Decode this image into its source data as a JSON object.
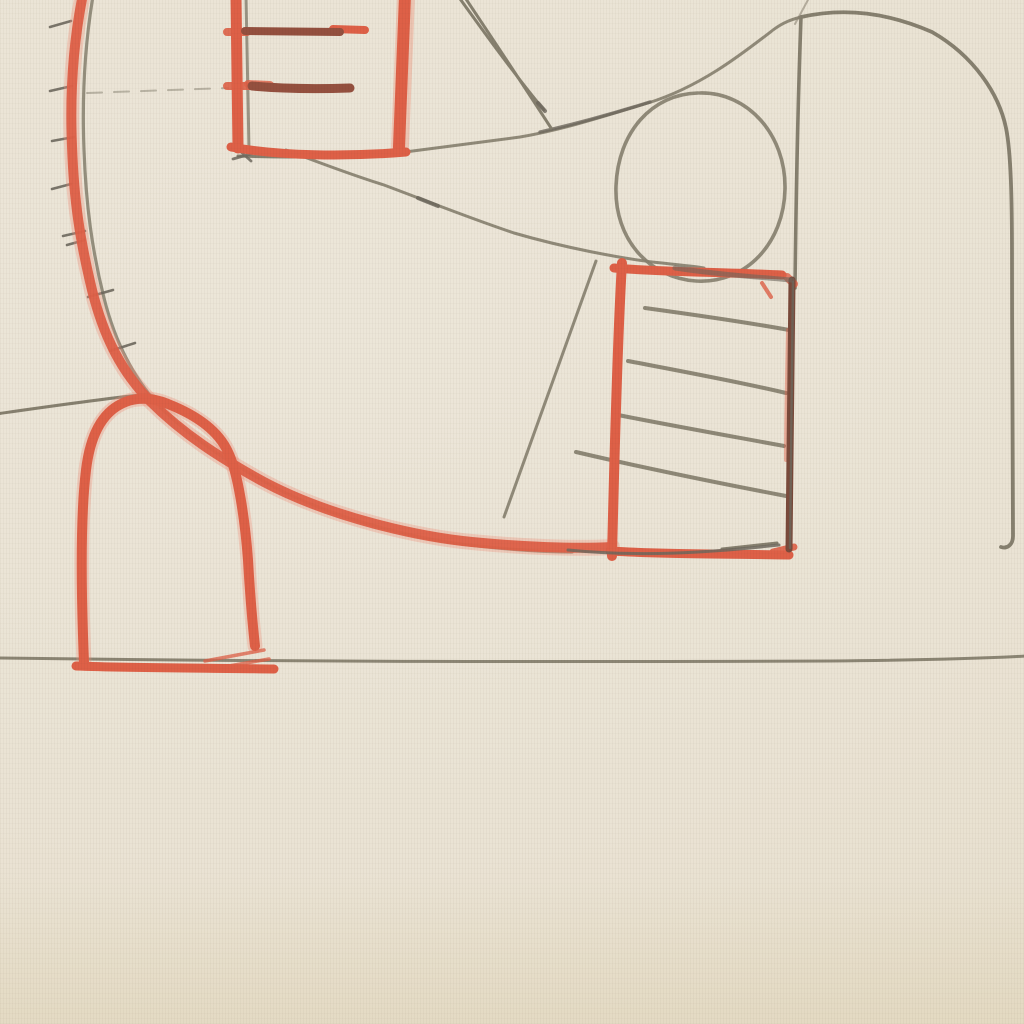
{
  "artwork": {
    "kind": "Abstract drawing in graphite pencil and red crayon on cream laid paper",
    "elements": {
      "big_red_arc": "Large red crayon arc sweeping from the top edge, bowing left, down and right into the middle ladder; a thin pencil line runs parallel along its inner side",
      "hatch_ticks": "Seven short pencil hatch marks poking out of the arc's outer (left) side",
      "top_ladder": "Red open rectangle at the top with two dark-red rungs, a pencil line inside its left edge and a pencil line along its base",
      "long_curves": "Two long pencil curves fanning right from the base of the top ladder: one rising to the tall arch corner, one falling to the middle ladder top",
      "double_diagonal": "Two parallel pencil strokes slanting down-right from the top edge",
      "pencil_oval": "Pencil oval resting on and smearing across the middle ladder's top edge",
      "tall_arch": "Large pencil arch spanning the upper-right quadrant, its left leg dropping to the middle ladder and its right side running down to a small foot",
      "middle_ladder": "Red crayon rectangle right of centre with four down-sloping pencil rungs and a dark brown-red right edge",
      "centre_diagonal": "Straight pencil diagonal dropping left from the middle ladder's top-left corner",
      "bottom_arch": "Red crayon dome at lower left standing on a red base line with scratch marks",
      "horizon_line": "Single pencil line running the full width at about two-thirds height",
      "left_edge_line": "Faint pencil line entering from the left edge to meet the red arc",
      "dashed_guide": "Faint broken pencil line near the upper left",
      "specks": "Tiny paper flecks: one cyan at top, orange and dark specks scattered"
    }
  },
  "colors": {
    "paper": "#eae3d4",
    "paper_shadow": "#e7dfcd",
    "pencil": "#86806f",
    "pencil_dark": "#6e685e",
    "crayon_red": "#de6047",
    "crayon_red_light": "#ef9078",
    "crayon_dark_red": "#94503f",
    "crayon_brown": "#7a4a3b",
    "speck_cyan": "#3cb8ae",
    "speck_orange": "#cd8a3f",
    "speck_yellow": "#d8b765",
    "speck_dark": "#57524a",
    "smudge": "rgba(160,150,125,0.18)"
  }
}
